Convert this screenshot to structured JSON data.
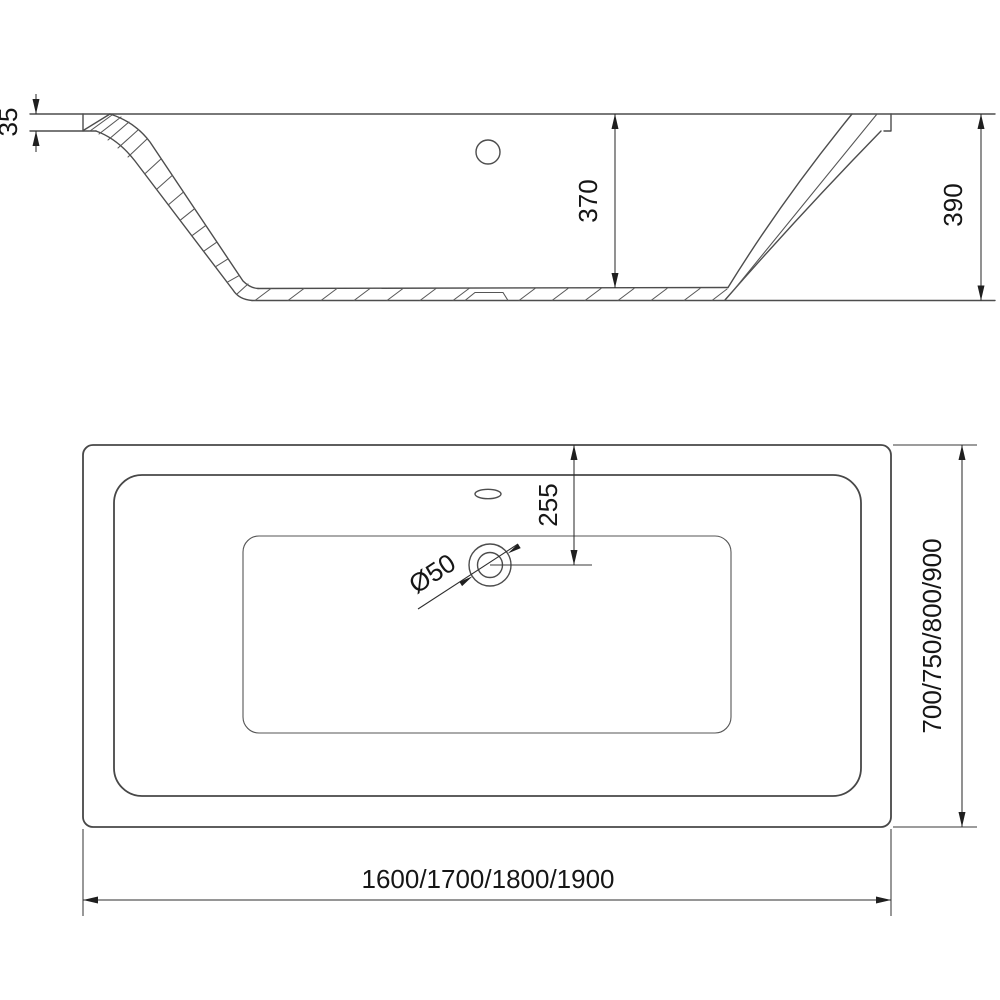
{
  "drawing": {
    "type": "bathtub-technical-drawing",
    "views": {
      "section": {
        "name": "side-section-view",
        "dims": {
          "rim_thickness": "35",
          "inner_depth": "370",
          "total_height": "390"
        }
      },
      "plan": {
        "name": "top-plan-view",
        "dims": {
          "drain_offset": "255",
          "drain_diameter": "Ø50",
          "width_options": "700/750/800/900",
          "length_options": "1600/1700/1800/1900"
        }
      }
    },
    "colors": {
      "line": "#4d4d4d",
      "dimension": "#2e2e2e",
      "text": "#161616",
      "background": "#ffffff"
    }
  }
}
